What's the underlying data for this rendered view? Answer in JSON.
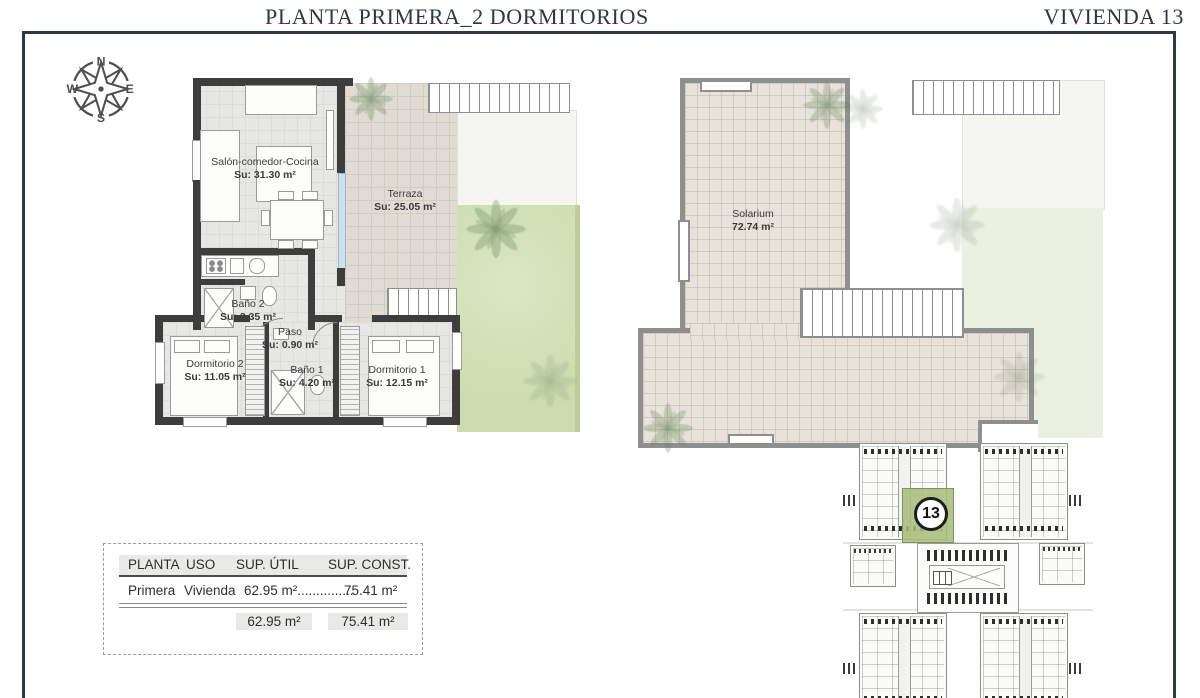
{
  "header": {
    "title_left": "PLANTA PRIMERA_2 DORMITORIOS",
    "title_right": "VIVIENDA 13"
  },
  "compass": {
    "north": "N",
    "east": "E",
    "south": "S",
    "west": "W"
  },
  "floor_plan": {
    "salon": {
      "name": "Salón-comedor-Cocina",
      "area": "Su: 31.30 m²"
    },
    "terraza": {
      "name": "Terraza",
      "area": "Su: 25.05 m²"
    },
    "bano2": {
      "name": "Baño 2",
      "area": "Su: 3.35 m²"
    },
    "paso": {
      "name": "Paso",
      "area": "Su: 0.90 m²"
    },
    "dormitorio2": {
      "name": "Dormitorio 2",
      "area": "Su: 11.05 m²"
    },
    "bano1": {
      "name": "Baño 1",
      "area": "Su: 4.20 m²"
    },
    "dormitorio1": {
      "name": "Dormitorio 1",
      "area": "Su: 12.15 m²"
    }
  },
  "solarium_plan": {
    "name": "Solarium",
    "area": "72.74 m²"
  },
  "summary_table": {
    "col_planta": "PLANTA",
    "col_uso": "USO",
    "col_sup_util": "SUP. ÚTIL",
    "col_sup_const": "SUP. CONST.",
    "row_planta": "Primera",
    "row_uso": "Vivienda",
    "row_sup_util": "62.95 m²",
    "row_leader": "...............",
    "row_sup_const": "75.41 m²",
    "total_sup_util": "62.95 m²",
    "total_sup_const": "75.41 m²"
  },
  "site_plan": {
    "highlighted_unit": "13"
  },
  "colors": {
    "accent_navy": "#2e3845",
    "wall_dark": "#3d3d3d",
    "highlight_green": "#a8bc7c",
    "garden_green": "#cfdfb4",
    "terrace_beige": "#e0dcd3"
  }
}
